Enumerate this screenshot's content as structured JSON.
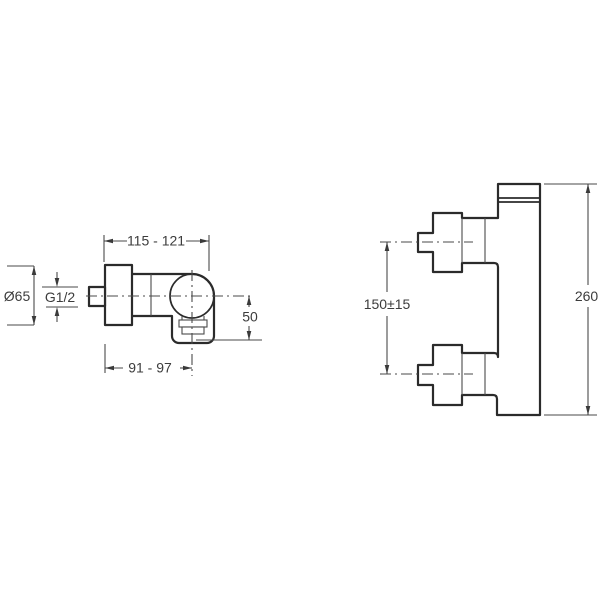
{
  "drawing": {
    "background_color": "#ffffff",
    "outline_color": "#2b2b2b",
    "dimension_line_color": "#4a4a4a",
    "text_color": "#3c3c3c",
    "views": {
      "side": {
        "dims": {
          "width_range": "115 - 121",
          "flange_diameter": "Ø65",
          "inlet_thread": "G1/2",
          "depth_to_axis": "91 - 97",
          "outlet_drop": "50"
        }
      },
      "front": {
        "dims": {
          "inlet_spacing": "150±15",
          "overall_height": "260"
        }
      }
    }
  }
}
